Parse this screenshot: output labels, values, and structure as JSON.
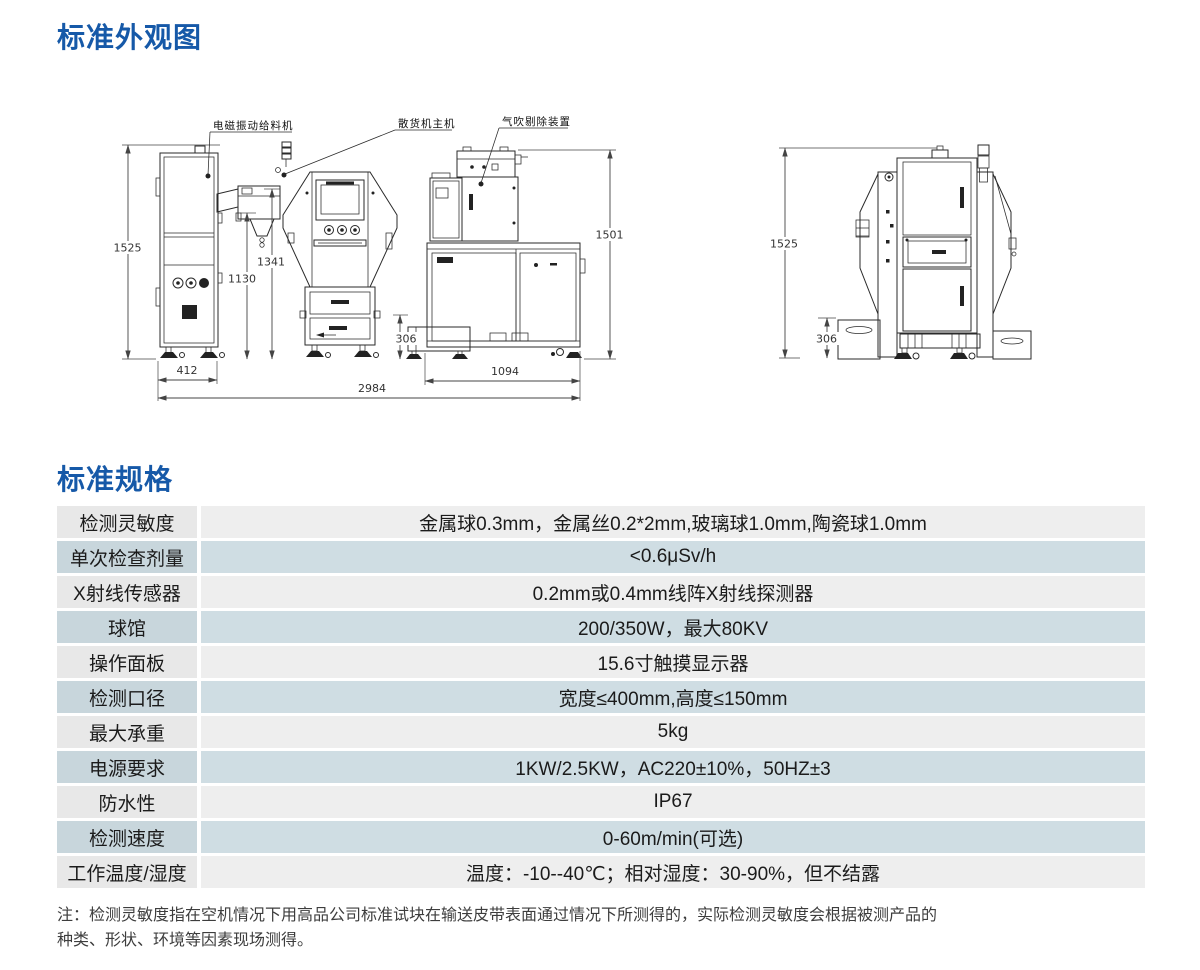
{
  "page": {
    "appearance_title": "标准外观图",
    "spec_title": "标准规格"
  },
  "colors": {
    "accent_blue": "#1659a8",
    "row_gray": "#eeeeee",
    "row_blue": "#cfdde3",
    "line_color": "#2a2a2a"
  },
  "drawing_front": {
    "labels": {
      "feeder": "电磁振动给料机",
      "main": "散货机主机",
      "blower": "气吹剔除装置"
    },
    "dims": {
      "d1525": "1525",
      "d1341": "1341",
      "d1130": "1130",
      "d1501": "1501",
      "d306": "306",
      "d412": "412",
      "d1094": "1094",
      "d2984": "2984"
    }
  },
  "drawing_side": {
    "dims": {
      "d1525": "1525",
      "d306": "306"
    }
  },
  "spec_table": {
    "rows": [
      {
        "label": "检测灵敏度",
        "value": "金属球0.3mm，金属丝0.2*2mm,玻璃球1.0mm,陶瓷球1.0mm"
      },
      {
        "label": "单次检查剂量",
        "value": "<0.6μSv/h"
      },
      {
        "label": "X射线传感器",
        "value": "0.2mm或0.4mm线阵X射线探测器"
      },
      {
        "label": "球馆",
        "value": "200/350W，最大80KV"
      },
      {
        "label": "操作面板",
        "value": "15.6寸触摸显示器"
      },
      {
        "label": "检测口径",
        "value": "宽度≤400mm,高度≤150mm"
      },
      {
        "label": "最大承重",
        "value": "5kg"
      },
      {
        "label": "电源要求",
        "value": "1KW/2.5KW，AC220±10%，50HZ±3"
      },
      {
        "label": "防水性",
        "value": "IP67"
      },
      {
        "label": "检测速度",
        "value": "0-60m/min(可选)"
      },
      {
        "label": "工作温度/湿度",
        "value": "温度：-10--40℃；相对湿度：30-90%，但不结露"
      }
    ]
  },
  "note": {
    "lines": [
      "注：检测灵敏度指在空机情况下用高品公司标准试块在输送皮带表面通过情况下所测得的，实际检测灵敏度会根据被测产品的",
      "种类、形状、环境等因素现场测得。"
    ]
  }
}
